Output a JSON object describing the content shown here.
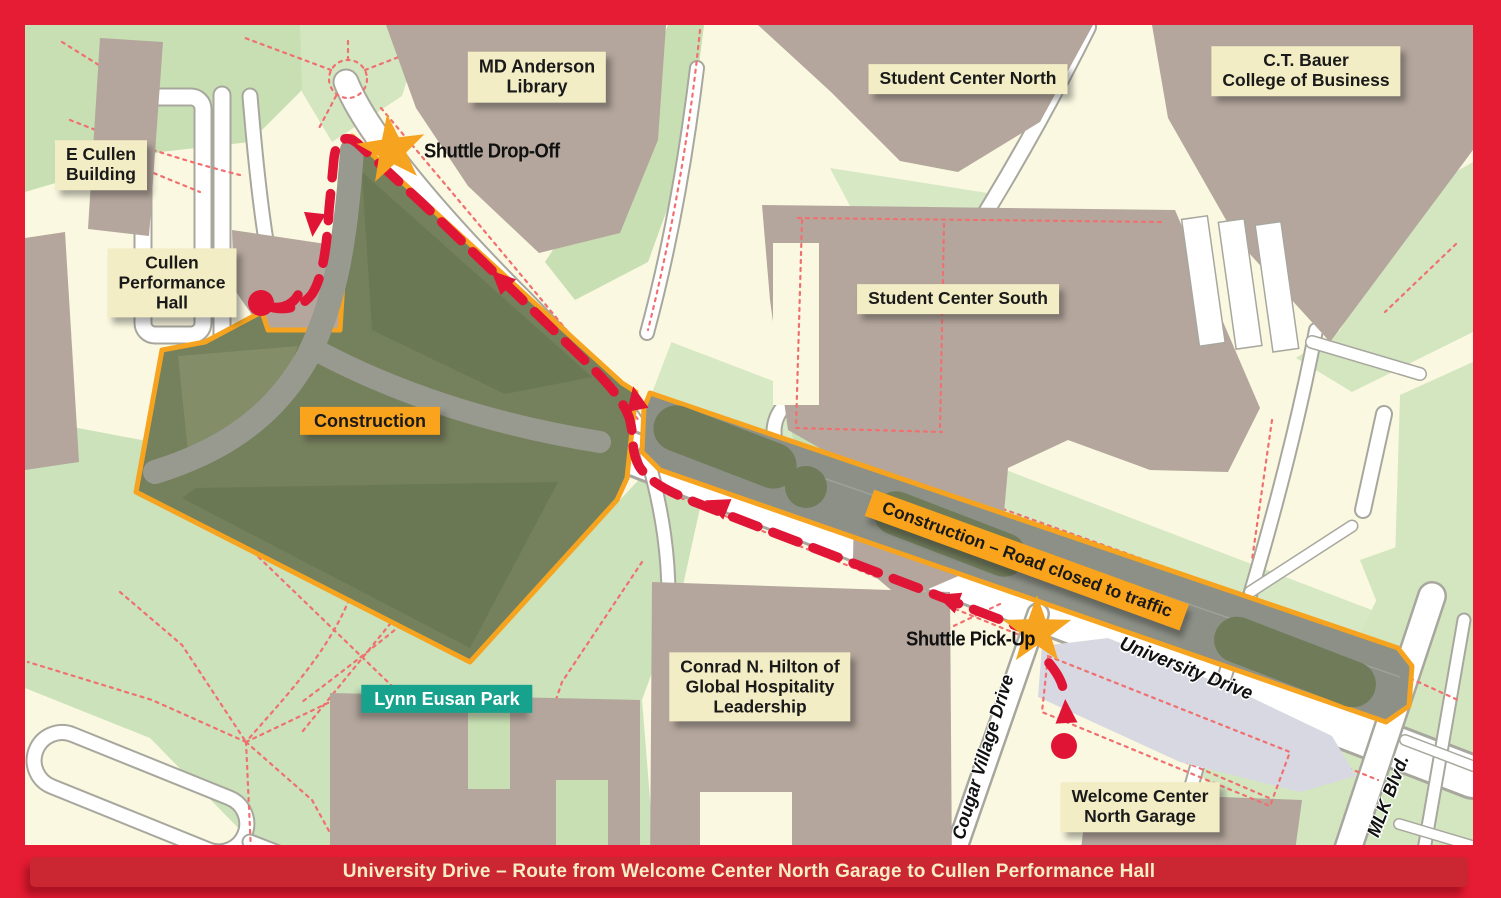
{
  "title_bar": {
    "text": "University Drive – Route from Welcome Center North Garage to Cullen Performance Hall"
  },
  "building_labels": {
    "md_anderson": {
      "line1": "MD Anderson",
      "line2": "Library"
    },
    "student_center_north": {
      "text": "Student Center North"
    },
    "ct_bauer": {
      "line1": "C.T. Bauer",
      "line2": "College of Business"
    },
    "e_cullen": {
      "line1": "E Cullen",
      "line2": "Building"
    },
    "cullen_performance_hall": {
      "line1": "Cullen",
      "line2": "Performance",
      "line3": "Hall"
    },
    "student_center_south": {
      "text": "Student Center South"
    },
    "conrad_hilton": {
      "line1": "Conrad N. Hilton of",
      "line2": "Global Hospitality",
      "line3": "Leadership"
    },
    "welcome_center_garage": {
      "line1": "Welcome Center",
      "line2": "North Garage"
    }
  },
  "construction": {
    "zone_label": "Construction",
    "road_closed_label": "Construction – Road closed to traffic"
  },
  "park": {
    "label": "Lynn Eusan Park"
  },
  "shuttle": {
    "drop_off_label": "Shuttle Drop-Off",
    "pick_up_label": "Shuttle Pick-Up"
  },
  "streets": {
    "university_drive": "University Drive",
    "cougar_village_drive": "Cougar Village Drive",
    "mlk_blvd": "MLK Blvd."
  },
  "colors": {
    "frame_red": "#E51C33",
    "title_bar_red": "#CB2732",
    "title_text_cream": "#F6EEC5",
    "label_cream": "#F3EDC5",
    "construction_orange": "#F6A41F",
    "route_red": "#E01536",
    "star_orange": "#F6A41F",
    "park_label_teal": "#16A28C",
    "building_taupe": "#B4A69C",
    "park_green": "#CBE2BB",
    "closed_road_gray": "#8C9086",
    "garage_lavender": "#D8D8E2"
  }
}
